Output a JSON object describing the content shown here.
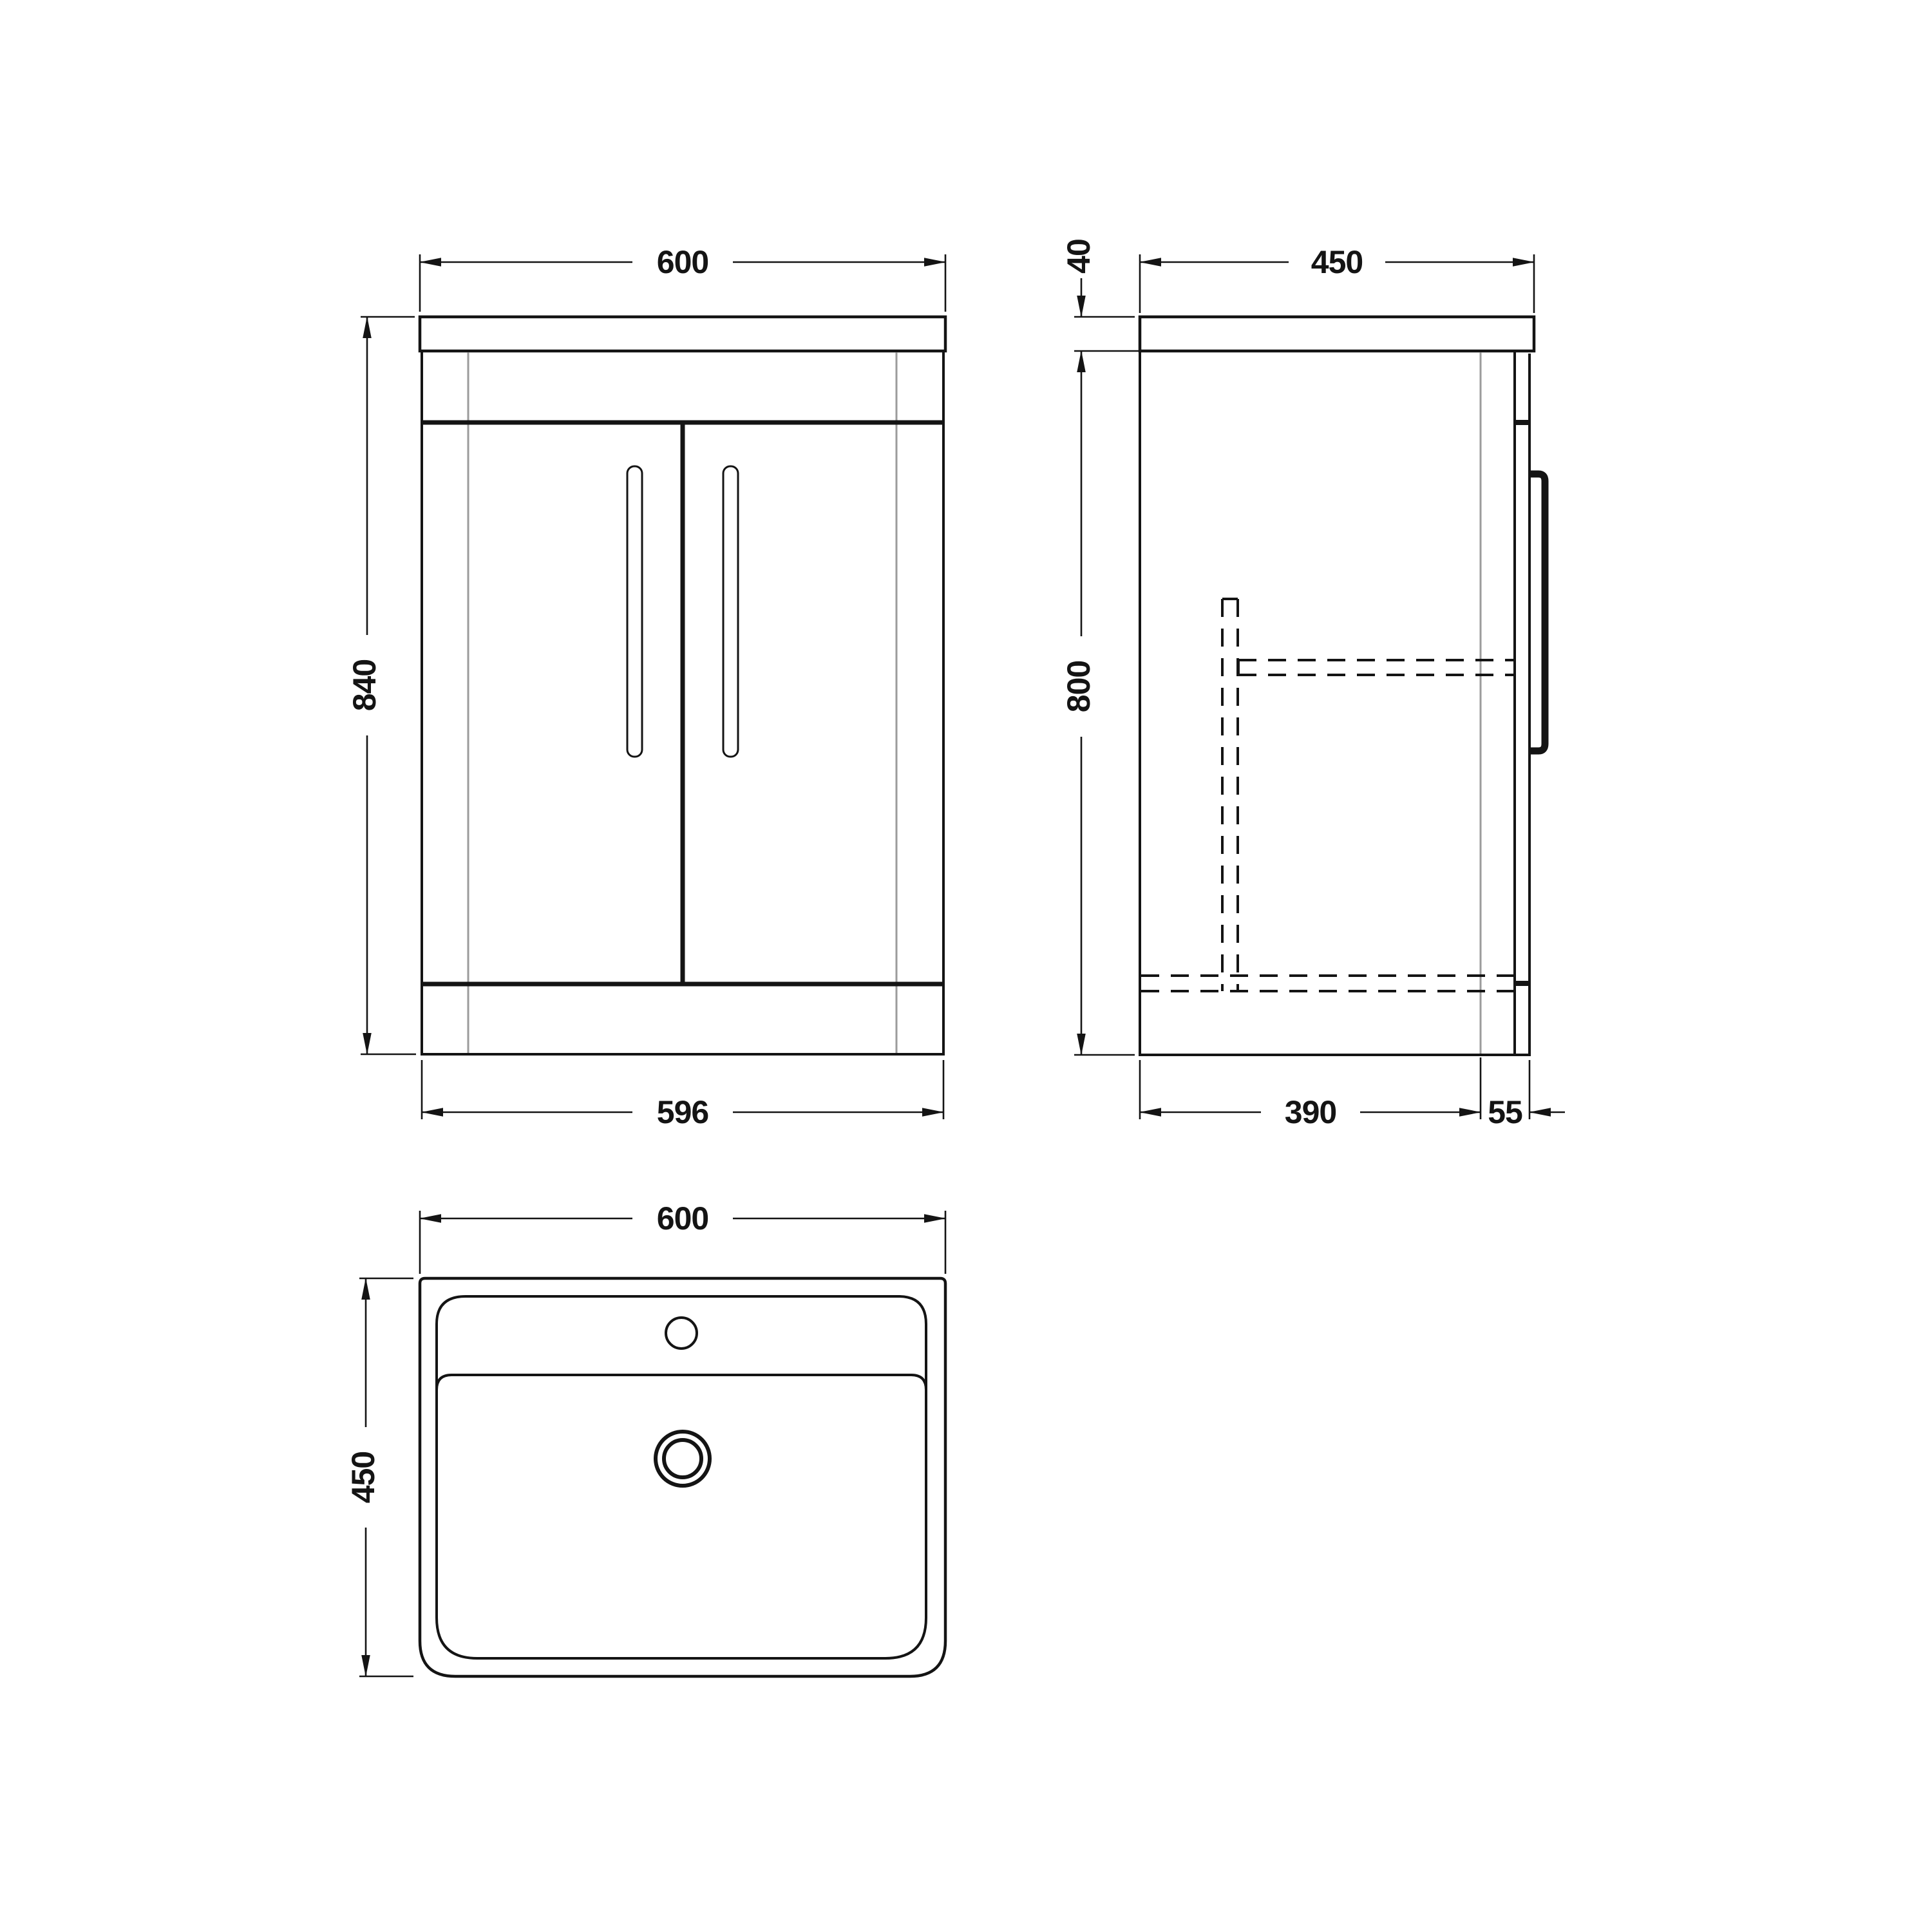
{
  "page": {
    "background_color": "#ffffff",
    "line_color": "#141414",
    "panel_seam_color": "#9b9b9b",
    "drawing_type": "vanity-unit-technical-drawing"
  },
  "views": {
    "front": {
      "name": "front-view",
      "dims": {
        "width_top": "600",
        "height": "840",
        "width_bottom": "596"
      }
    },
    "side": {
      "name": "side-view",
      "dims": {
        "counter_thickness": "40",
        "depth_top": "450",
        "height": "800",
        "body_depth": "390",
        "door_offset": "55"
      }
    },
    "plan": {
      "name": "plan-view",
      "dims": {
        "width_top": "600",
        "depth_left": "450"
      }
    }
  }
}
